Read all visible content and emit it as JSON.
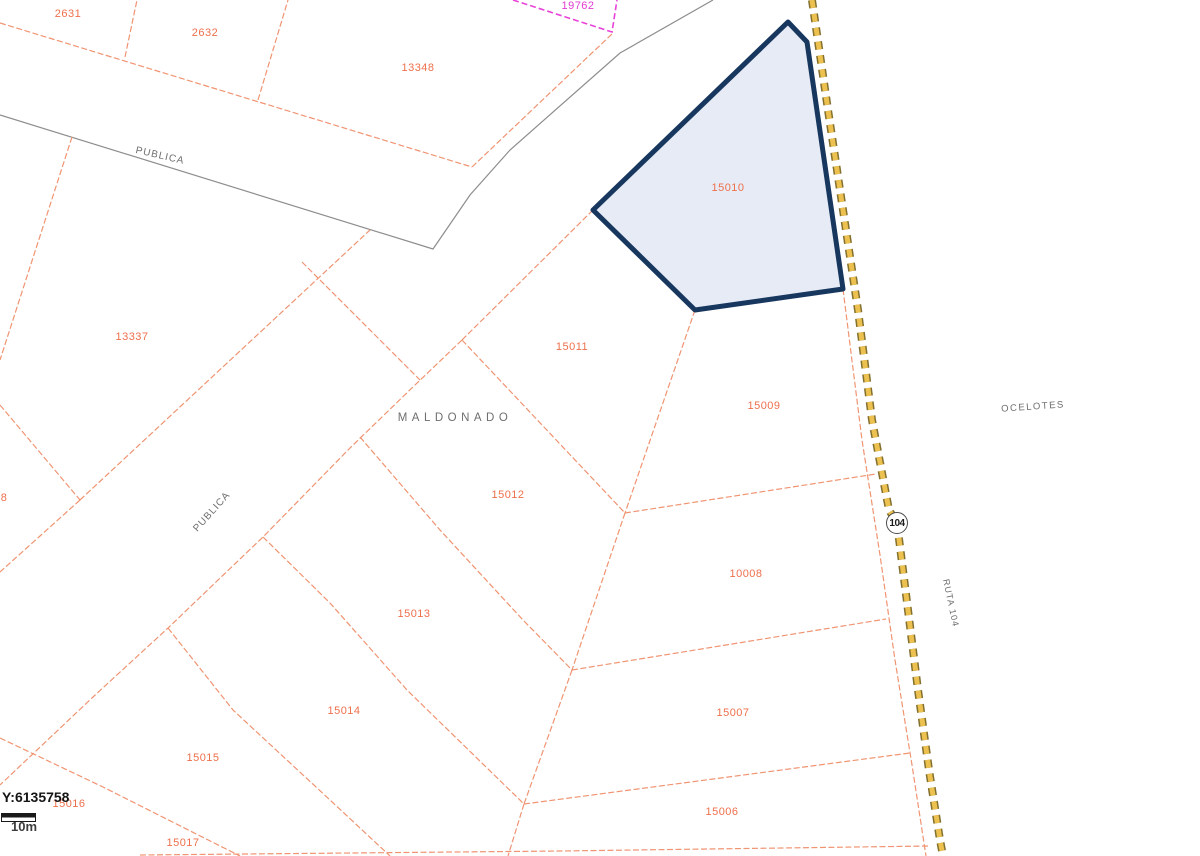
{
  "map": {
    "title": "cadastral-parcel-map",
    "colors": {
      "parcel_line": "#f09472",
      "parcel_label": "#ee6f4c",
      "magenta": "#e23ad2",
      "gray_line": "#8d8d8d",
      "highlight_border": "#17375e",
      "highlight_fill": "#e7ebf5",
      "route_yellow": "#ecc14f"
    },
    "highlighted_parcel_id": "15010",
    "parcel_labels": [
      {
        "id": "2631",
        "x": 68,
        "y": 14
      },
      {
        "id": "2632",
        "x": 205,
        "y": 33
      },
      {
        "id": "13348",
        "x": 418,
        "y": 68
      },
      {
        "id": "19762",
        "x": 578,
        "y": 6,
        "magenta": true
      },
      {
        "id": "15010",
        "x": 728,
        "y": 188
      },
      {
        "id": "13337",
        "x": 132,
        "y": 337
      },
      {
        "id": "15011",
        "x": 572,
        "y": 347
      },
      {
        "id": "15009",
        "x": 764,
        "y": 406
      },
      {
        "id": "8",
        "x": 4,
        "y": 498
      },
      {
        "id": "15012",
        "x": 508,
        "y": 495
      },
      {
        "id": "10008",
        "x": 746,
        "y": 574
      },
      {
        "id": "15013",
        "x": 414,
        "y": 614
      },
      {
        "id": "15014",
        "x": 344,
        "y": 711
      },
      {
        "id": "15007",
        "x": 733,
        "y": 713
      },
      {
        "id": "15015",
        "x": 203,
        "y": 758
      },
      {
        "id": "15016",
        "x": 69,
        "y": 804
      },
      {
        "id": "15006",
        "x": 722,
        "y": 812
      },
      {
        "id": "15017",
        "x": 183,
        "y": 843
      }
    ],
    "street_labels": [
      {
        "text": "PUBLICA",
        "x": 160,
        "y": 156,
        "rot": 13,
        "spacing": 1,
        "size": 10
      },
      {
        "text": "PUBLICA",
        "x": 212,
        "y": 512,
        "rot": -48,
        "spacing": 1,
        "size": 10
      },
      {
        "text": "MALDONADO",
        "x": 455,
        "y": 418,
        "rot": 0,
        "spacing": 4.5,
        "size": 11.5
      },
      {
        "text": "OCELOTES",
        "x": 1033,
        "y": 407,
        "rot": -4,
        "spacing": 1.5,
        "size": 9.5
      },
      {
        "text": "RUTA 104",
        "x": 951,
        "y": 603,
        "rot": 78,
        "spacing": 1,
        "size": 9
      }
    ],
    "route_shield": {
      "number": "104"
    },
    "status": {
      "y_coordinate": "Y:6135758",
      "scale_label": "10m"
    }
  }
}
